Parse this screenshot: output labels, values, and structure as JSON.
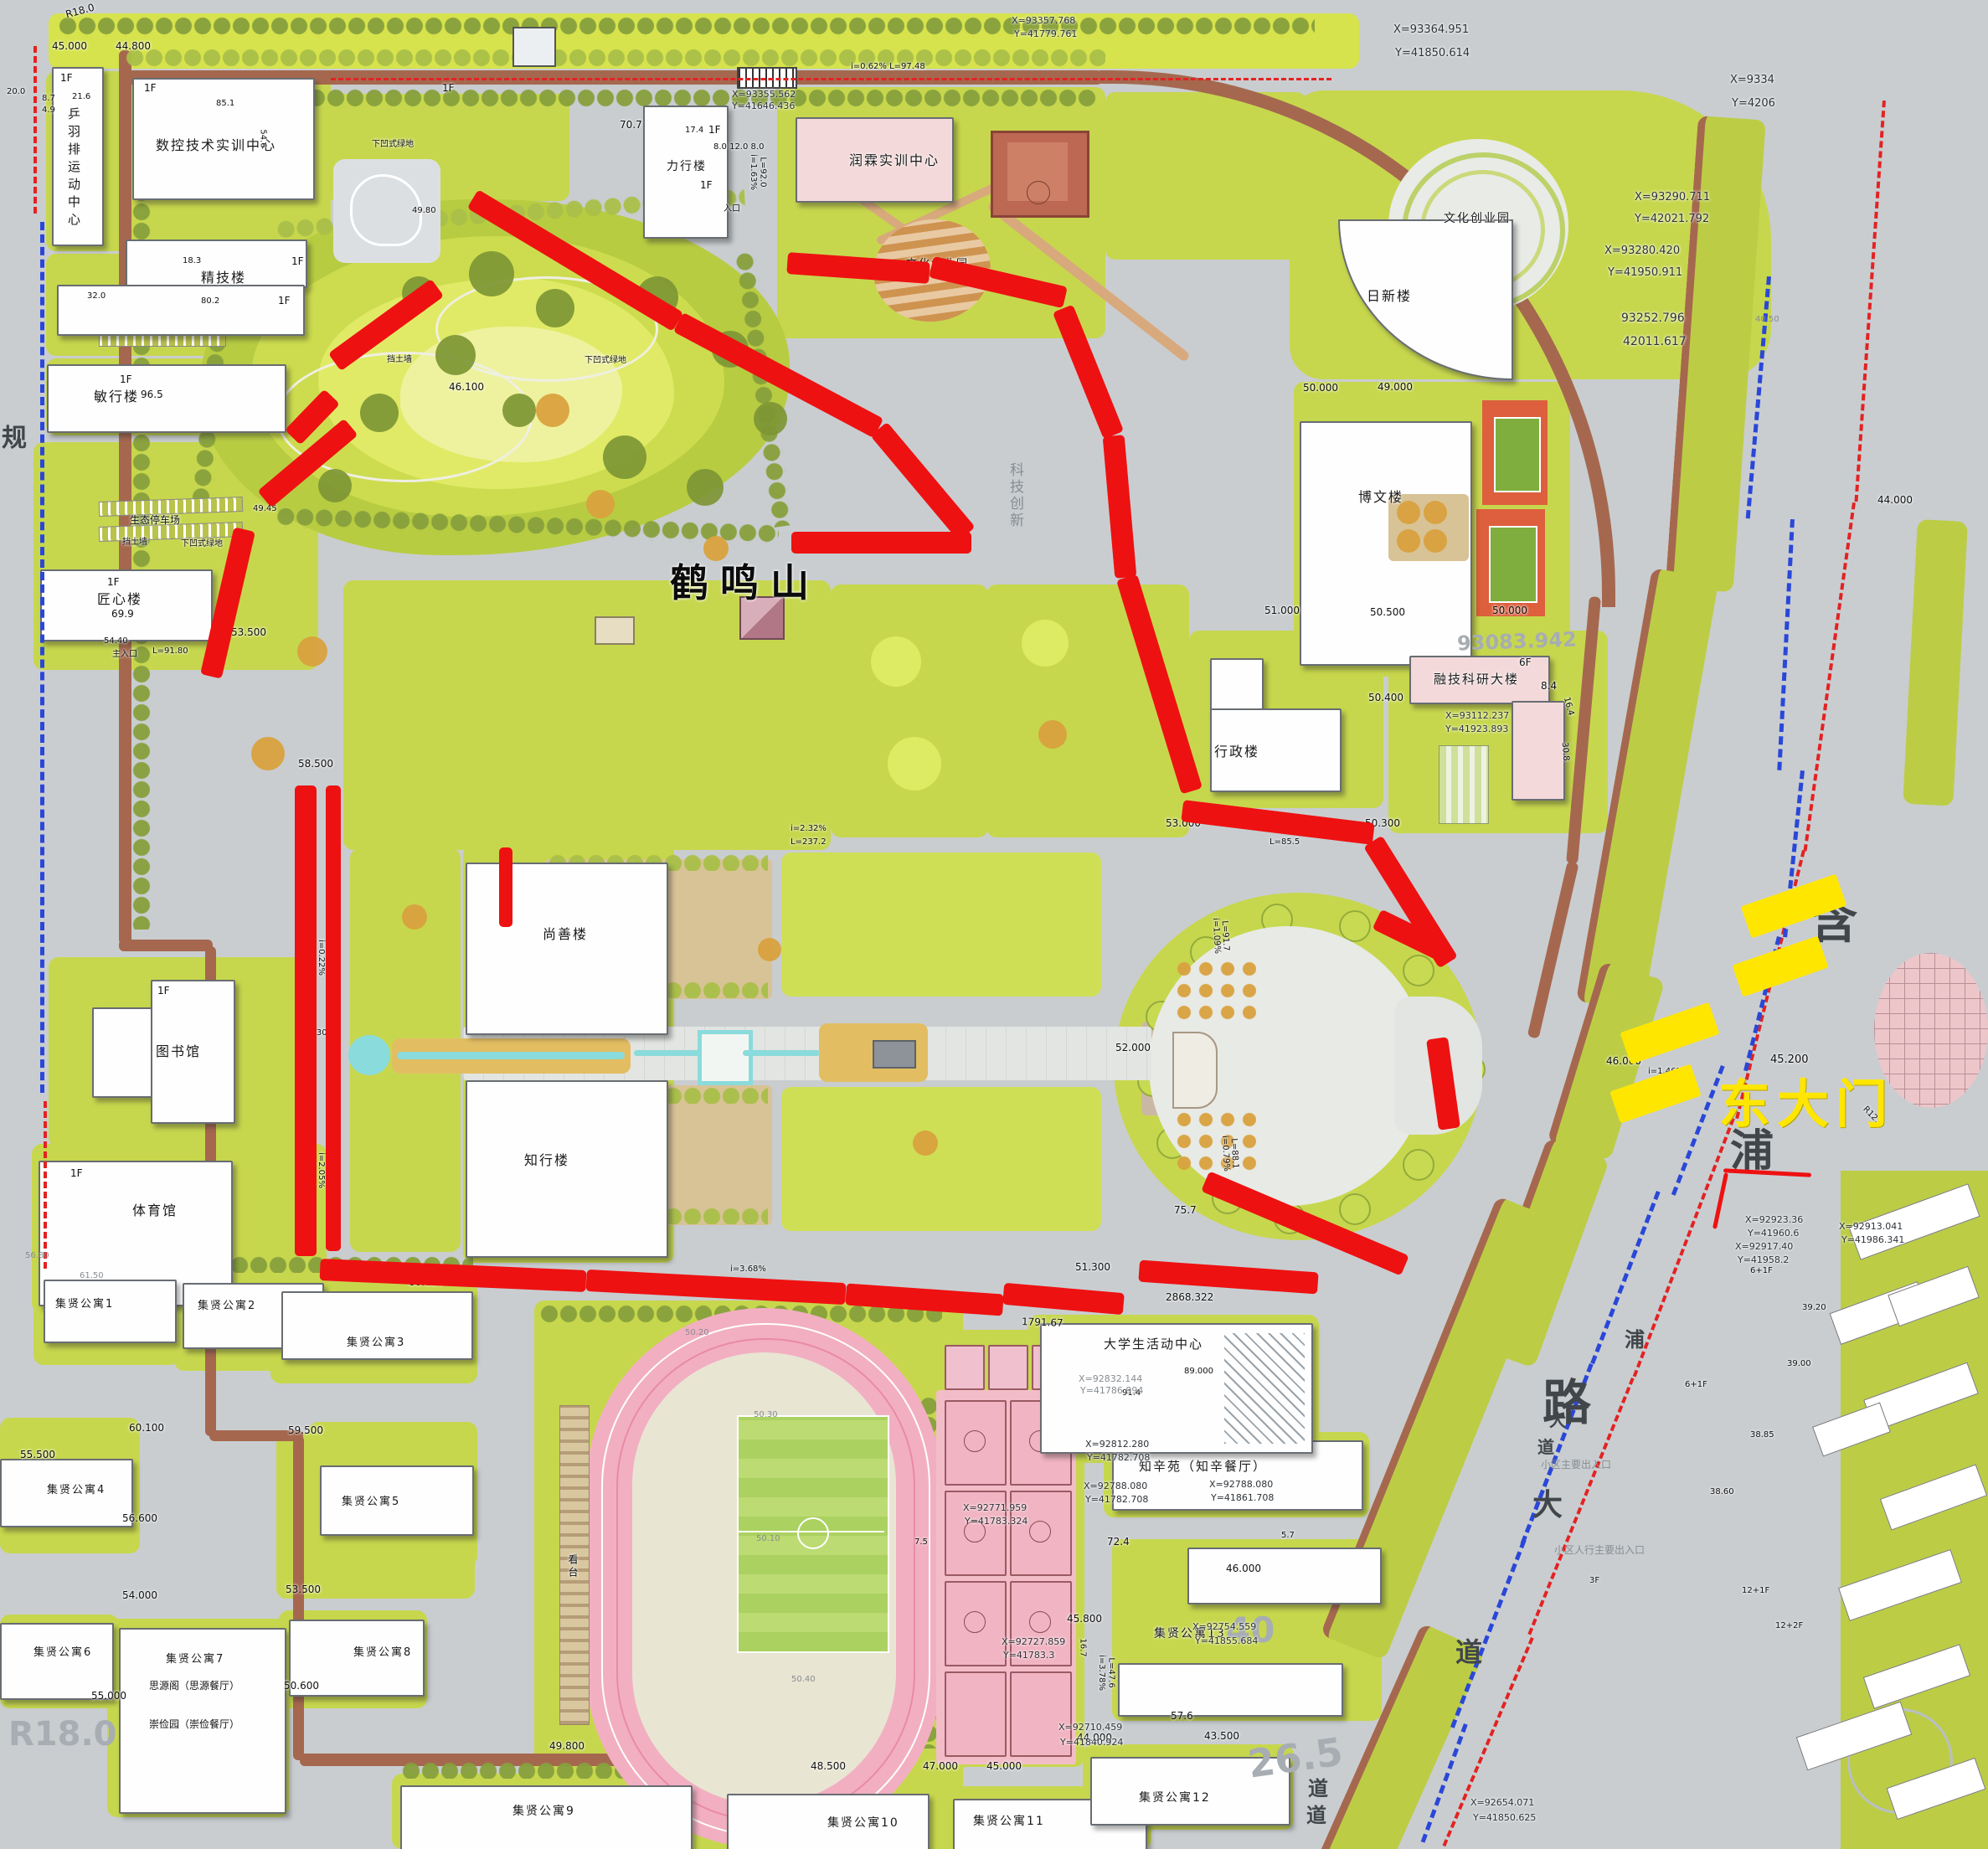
{
  "colors": {
    "route_red": "#ee1111",
    "gate_yellow": "#ffe600",
    "campus_green": "#c7d74d",
    "track_pink": "#f2afc2",
    "water_cyan": "#8adbdb",
    "ring_road_brown": "#a5684f",
    "boundary_blue": "#2a47d8",
    "building_pink": "#f4d9da"
  },
  "buildings": {
    "pingyu_sports": "乒羽排运动中心",
    "cnc_center": "数控技术实训中心",
    "jingji": "精技楼",
    "minxing": "敏行楼",
    "jiangxin": "匠心楼",
    "lixing": "力行楼",
    "runlin": "润霖实训中心",
    "rixin": "日新楼",
    "bowen": "博文楼",
    "xingzheng": "行政楼",
    "rongji": "融技科研大楼",
    "shangshan": "尚善楼",
    "zhixing": "知行楼",
    "library": "图书馆",
    "gym": "体育馆",
    "activity_center": "大学生活动中心",
    "zhixinyuan": "知辛苑（知辛餐厅）",
    "apt1": "集贤公寓1",
    "apt2": "集贤公寓2",
    "apt3": "集贤公寓3",
    "apt4": "集贤公寓4",
    "apt5": "集贤公寓5",
    "apt6": "集贤公寓6",
    "apt7": "集贤公寓7",
    "apt8": "集贤公寓8",
    "apt9": "集贤公寓9",
    "apt10": "集贤公寓10",
    "apt11": "集贤公寓11",
    "apt12": "集贤公寓12",
    "apt13": "集贤公寓13",
    "siyuan": "思源阁（思源餐厅）",
    "chongjian": "崇俭园（崇俭餐厅）"
  },
  "areas": {
    "hill": "鹤鸣山",
    "culture_park1": "文化创业园",
    "culture_park2": "文化创业园",
    "eco_parking": "生态停车场",
    "retaining_wall1": "挡土墙",
    "sunken_green1": "下凹式绿地",
    "retaining_wall2": "挡土墙",
    "sunken_green2": "下凹式绿地",
    "sunken_green3": "下凹式绿地",
    "grandstand": "看台",
    "east_gate": "东大门",
    "main_entrance": "主入口",
    "entrance": "入口",
    "community_main_entrance": "小区主要出入口",
    "community_ped_entrance": "小区人行主要出入口",
    "tech_innovation": "科技创新",
    "planning_road_char": "规"
  },
  "road_chars": [
    "含",
    "浦",
    "路",
    "大",
    "道",
    "浦",
    "大",
    "道",
    "道",
    "道"
  ],
  "t": {
    "tl": [
      "R18.0",
      "45.000",
      "44.800",
      "20.0",
      "8.7",
      "4.9",
      "1F",
      "21.6",
      "1F",
      "85.1",
      "54.6",
      "1F",
      "18.3",
      "32.0",
      "80.2",
      "1F",
      "1F",
      "96.5",
      "49.80",
      "1F",
      "69.9",
      "55.500",
      "56.80",
      "61.50"
    ],
    "tm": [
      "1F",
      "70.7",
      "17.4",
      "8.0 12.0 8.0",
      "i=1.63%",
      "L=92.0",
      "1F",
      "1F",
      "X=93355.562",
      "Y=41646.436",
      "i=0.62%  L=97.48",
      "X=93357.768",
      "Y=41779.761"
    ],
    "tr": [
      "X=93364.951",
      "Y=41850.614",
      "X=9334",
      "Y=4206",
      "X=93290.711",
      "Y=42021.792",
      "X=93280.420",
      "Y=41950.911",
      "93252.796",
      "42011.617",
      "50.000",
      "49.000",
      "40.50"
    ],
    "hl": [
      "46.100",
      "58.500",
      "53.500",
      "54.40",
      "L=91.80",
      "49.45"
    ],
    "mr": [
      "51.000",
      "50.500",
      "50.000",
      "50.400",
      "53.000",
      "50.300",
      "L=85.5",
      "X=93112.237",
      "Y=41923.893",
      "6F",
      "8.4",
      "16.4",
      "30.8",
      "93083.942",
      "44.000"
    ],
    "qd": [
      "1F",
      "1F",
      "i=0.22%",
      "L=90.7",
      "58.30",
      "i=2.05%",
      "L=87.8",
      "i=2.32%",
      "L=237.2",
      "52.000",
      "i=3.68%",
      "51.300",
      "2868.322",
      "1791.67",
      "i=0.79%",
      "L=88.1",
      "i=1.09%",
      "L=91.7",
      "75.7",
      "L=183.8",
      "60.000"
    ],
    "gt": [
      "45.200",
      "46.000",
      "i=1.46%",
      "L=54.9",
      "X=92923.36",
      "Y=41960.6",
      "X=92917.40",
      "Y=41958.2",
      "X=92913.041",
      "Y=41986.341",
      "R12.0"
    ],
    "er": [
      "39.20",
      "39.00",
      "38.85",
      "38.60",
      "6+1F",
      "6+1F",
      "12+1F",
      "3F",
      "12+2F",
      "X=92654.071",
      "Y=41850.625"
    ],
    "st": [
      "89.000",
      "91.4",
      "X=92832.144",
      "Y=41786.994",
      "X=92812.280",
      "Y=41782.708",
      "X=92788.080",
      "Y=41782.708",
      "X=92788.080",
      "Y=41861.708",
      "7.5",
      "72.4",
      "5.7",
      "46.000",
      "45.800",
      "16.7",
      "57.6",
      "43.500",
      "44.000",
      "i=3.78%",
      "L=47.6",
      "X=92710.459",
      "Y=41840.924",
      "X=92771.959",
      "Y=41783.324",
      "X=92727.859",
      "Y=41783.3",
      "49.800",
      "48.500",
      "47.000",
      "45.000",
      "50.30",
      "50.10",
      "50.40",
      "50.20",
      "X=92754.559",
      "Y=41855.684",
      "26.5",
      "40"
    ],
    "ws": [
      "60.100",
      "59.500",
      "56.600",
      "54.000",
      "53.500",
      "55.000",
      "50.600",
      "R18.0"
    ]
  }
}
